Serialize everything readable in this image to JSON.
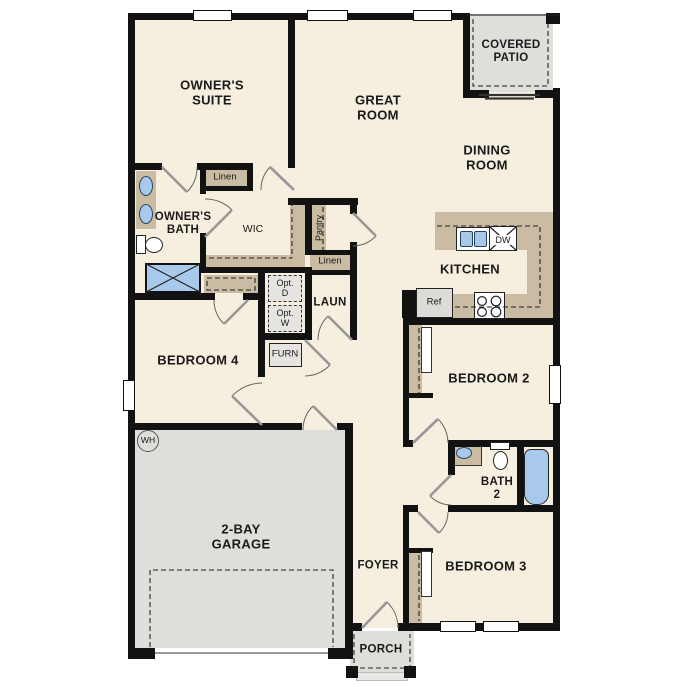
{
  "meta": {
    "title": "Single-story floor plan",
    "canvas_width": 687,
    "canvas_height": 687
  },
  "palette": {
    "wall": "#121212",
    "floor_cream": "#f6efdf",
    "floor_gray": "#dfdedb",
    "cabinet_tan": "#c9bca3",
    "fixture_blue": "#a9c9ea",
    "appliance_gray": "#e5e4e1"
  },
  "rooms": {
    "owners_suite": {
      "label": "OWNER'S\nSUITE"
    },
    "great_room": {
      "label": "GREAT\nROOM"
    },
    "covered_patio": {
      "label": "COVERED\nPATIO"
    },
    "dining_room": {
      "label": "DINING\nROOM"
    },
    "owners_bath": {
      "label": "OWNER'S\nBATH"
    },
    "wic": {
      "label": "WIC"
    },
    "kitchen": {
      "label": "KITCHEN"
    },
    "laundry": {
      "label": "LAUN"
    },
    "bedroom4": {
      "label": "BEDROOM 4"
    },
    "bedroom2": {
      "label": "BEDROOM 2"
    },
    "bath2": {
      "label": "BATH\n2"
    },
    "garage": {
      "label": "2-BAY\nGARAGE"
    },
    "foyer": {
      "label": "FOYER"
    },
    "bedroom3": {
      "label": "BEDROOM 3"
    },
    "porch": {
      "label": "PORCH"
    }
  },
  "closets": {
    "linen_suite": {
      "label": "Linen"
    },
    "pantry": {
      "label": "Pantry"
    },
    "linen_hall": {
      "label": "Linen"
    }
  },
  "fixtures": {
    "furnace": {
      "label": "FURN"
    },
    "water_heater": {
      "label": "WH"
    },
    "refrigerator": {
      "label": "Ref"
    },
    "dishwasher": {
      "label": "DW"
    },
    "optional_dryer": {
      "label": "Opt.\nD"
    },
    "optional_washer": {
      "label": "Opt.\nW"
    }
  }
}
